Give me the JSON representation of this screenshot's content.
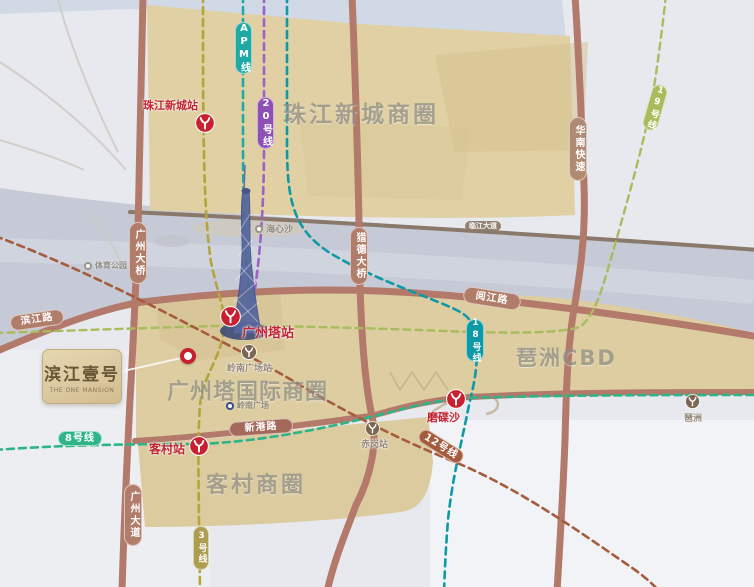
{
  "project": {
    "name": "滨江壹号",
    "name_en": "THE ONE MANSION"
  },
  "districts": {
    "zhujiang": "珠江新城商圈",
    "pazhou": "琶洲CBD",
    "canton_tower": "广州塔国际商圈",
    "kecun": "客村商圈"
  },
  "metro_lines": {
    "apm": {
      "label": "APM线",
      "color": "#1fa9a4"
    },
    "line20": {
      "label": "20号线",
      "color": "#8e50b4"
    },
    "line19": {
      "label": "19号线",
      "color": "#a9bc5d"
    },
    "line18": {
      "label": "18号线",
      "color": "#0d9aa6"
    },
    "line12": {
      "label": "12号线",
      "color": "#a55c3d"
    },
    "line8": {
      "label": "8号线",
      "color": "#2eb487"
    },
    "line3": {
      "label": "3号线",
      "color": "#ad9d4f"
    }
  },
  "stations": {
    "zhujiangxincheng": "珠江新城站",
    "guangzhouta": "广州塔站",
    "kecun": "客村站",
    "modiesha": "磨碟沙",
    "lingnanguangchang": "岭南广场站",
    "chigang": "赤岗站",
    "pazhou": "琶洲"
  },
  "roads": {
    "guangzhou_bridge": "广州大桥",
    "guangzhou_avenue": "广州大道",
    "binjiang_road": "滨江路",
    "yuejiang_road": "阅江路",
    "xingang_road": "新港路",
    "huanan_expressway": "华南快速",
    "liede_bridge": "猎德大桥",
    "linjiang_avenue": "临江大道"
  },
  "pois": {
    "haixinsha": "海心沙",
    "sports_park": "体育公园",
    "lingnan_plaza": "岭南广场"
  }
}
